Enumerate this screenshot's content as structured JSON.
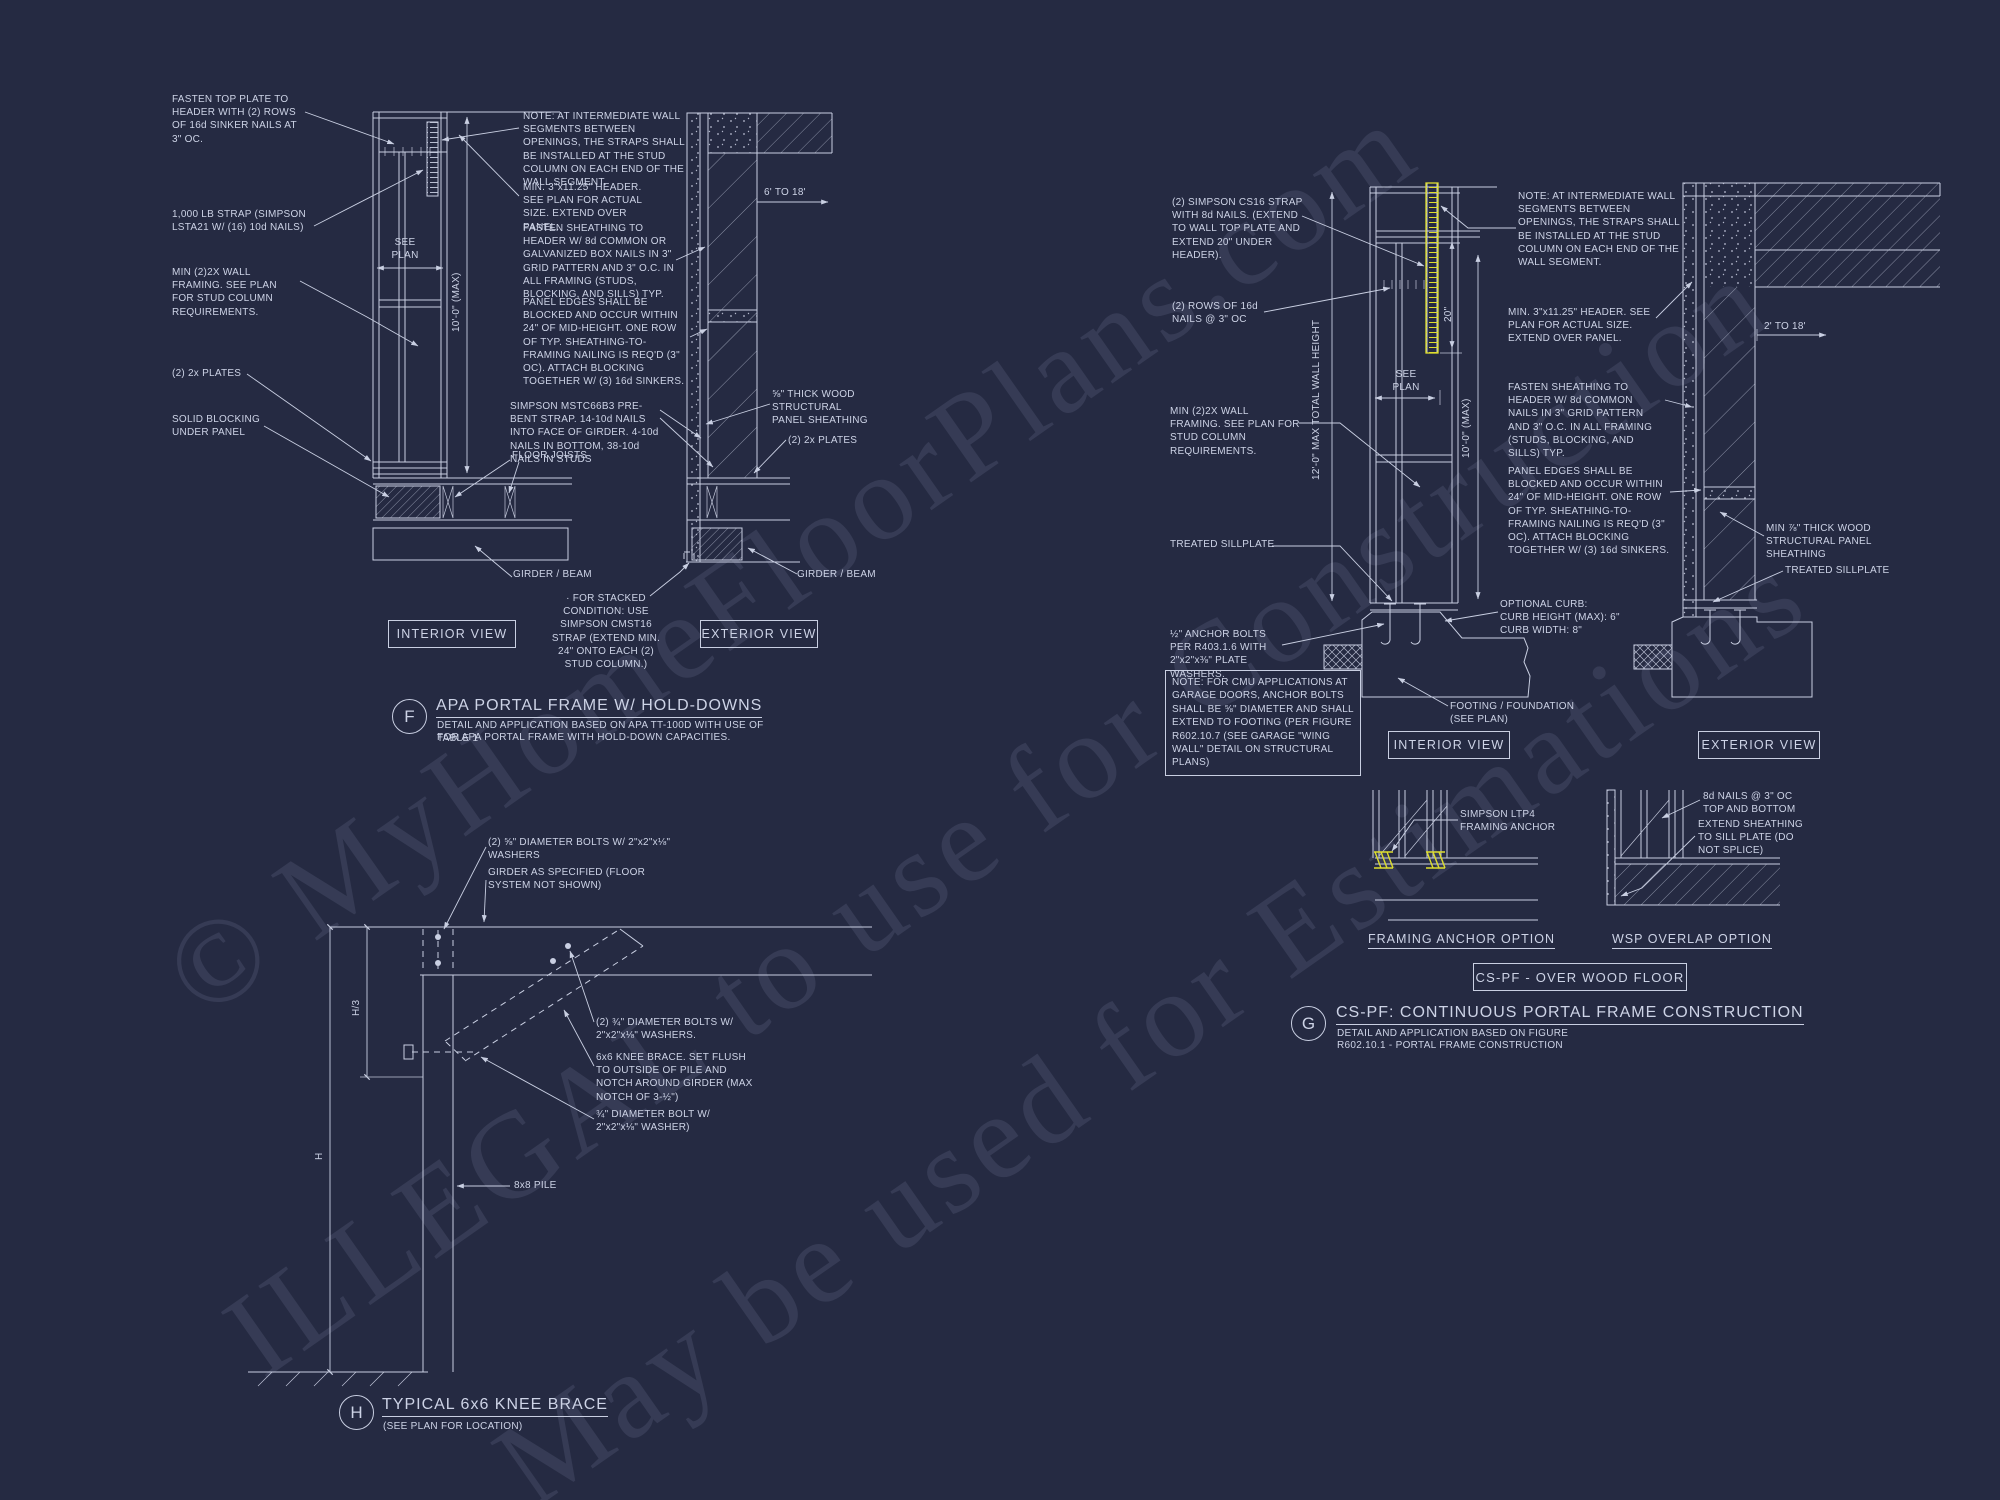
{
  "colors": {
    "background": "#252a42",
    "line": "#c9cfe2",
    "text": "#cdd3e6",
    "highlight": "#dede2e"
  },
  "watermark": {
    "line1": "© MyHomeFloorPlans.com",
    "line2": "ILLEGAL to use for Construction",
    "line3": "May be used for Estimations"
  },
  "f": {
    "tag": "F",
    "title": "APA PORTAL FRAME W/ HOLD-DOWNS",
    "subtitle1": "DETAIL AND APPLICATION BASED ON APA TT-100D WITH USE OF TABLE 1",
    "subtitle2": "FOR APA PORTAL FRAME WITH HOLD-DOWN CAPACITIES.",
    "interior_view": "INTERIOR VIEW",
    "exterior_view": "EXTERIOR VIEW",
    "labels": {
      "fasten_top_plate": "FASTEN TOP PLATE TO HEADER WITH (2) ROWS OF 16d SINKER NAILS AT 3\" OC.",
      "strap_1000lb": "1,000 LB STRAP (SIMPSON LSTA21 W/ (16) 10d NAILS)",
      "min_wall_framing": "MIN (2)2X WALL FRAMING. SEE PLAN FOR STUD COLUMN REQUIREMENTS.",
      "plates_left": "(2) 2x PLATES",
      "solid_blocking": "SOLID BLOCKING UNDER PANEL",
      "see_plan": "SEE\nPLAN",
      "height_max": "10'-0\" (MAX)",
      "note_intermediate": "NOTE: AT INTERMEDIATE WALL SEGMENTS BETWEEN OPENINGS, THE STRAPS SHALL BE INSTALLED AT THE STUD COLUMN ON EACH END OF THE WALL SEGMENT.",
      "min_header": "MIN. 3\"x11.25\" HEADER. SEE PLAN FOR ACTUAL SIZE. EXTEND OVER PANEL.",
      "fasten_sheathing": "FASTEN SHEATHING TO HEADER W/ 8d COMMON OR GALVANIZED BOX NAILS IN 3\" GRID PATTERN AND 3\" O.C. IN ALL FRAMING (STUDS, BLOCKING, AND SILLS) TYP.",
      "panel_edges": "PANEL EDGES SHALL BE BLOCKED AND OCCUR WITHIN 24\" OF MID-HEIGHT.  ONE ROW OF TYP. SHEATHING-TO-FRAMING NAILING IS REQ'D (3\" OC). ATTACH BLOCKING TOGETHER W/ (3) 16d SINKERS.",
      "simpson_strap": "SIMPSON MSTC66B3 PRE-BENT STRAP. 14-10d NAILS INTO FACE OF GIRDER. 4-10d NAILS IN BOTTOM, 38-10d NAILS IN STUDS",
      "floor_joists": "FLOOR JOISTS",
      "opening_range": "6' TO 18'",
      "sheathing": "⅝\" THICK WOOD STRUCTURAL PANEL SHEATHING",
      "plates_right": "(2) 2x PLATES",
      "girder_left": "GIRDER / BEAM",
      "girder_right": "GIRDER / BEAM",
      "stacked": "· FOR STACKED CONDITION: USE SIMPSON CMST16 STRAP (EXTEND MIN. 24\" ONTO EACH (2) STUD COLUMN.)"
    }
  },
  "g": {
    "tag": "G",
    "title": "CS-PF: CONTINUOUS PORTAL FRAME CONSTRUCTION",
    "subtitle1": "DETAIL AND APPLICATION BASED ON  FIGURE",
    "subtitle2": "R602.10.1 - PORTAL FRAME CONSTRUCTION",
    "over_wood_floor": "CS-PF - OVER WOOD FLOOR",
    "framing_option": "FRAMING ANCHOR OPTION",
    "wsp_option": "WSP OVERLAP OPTION",
    "interior_view": "INTERIOR VIEW",
    "exterior_view": "EXTERIOR VIEW",
    "labels": {
      "cs16_strap": "(2) SIMPSON CS16 STRAP WITH 8d NAILS. (EXTEND TO WALL TOP PLATE AND EXTEND 20\" UNDER HEADER).",
      "rows_16d": "(2) ROWS OF 16d NAILS @ 3\" OC",
      "wall_height": "12'-0\" MAX TOTAL WALL HEIGHT",
      "see_plan": "SEE\nPLAN",
      "dim_20": "20\"",
      "height_max": "10'-0\" (MAX)",
      "min_wall_framing": "MIN (2)2X WALL FRAMING. SEE PLAN FOR STUD COLUMN REQUIREMENTS.",
      "sillplate_left": "TREATED SILLPLATE",
      "anchor_bolts": "½\" ANCHOR BOLTS PER R403.1.6 WITH 2\"x2\"x⅜\" PLATE WASHERS.",
      "cmu_note": "NOTE: FOR CMU APPLICATIONS AT GARAGE DOORS, ANCHOR BOLTS SHALL BE ⅝\" DIAMETER AND SHALL EXTEND TO FOOTING (PER  FIGURE R602.10.7 (SEE GARAGE \"WING WALL\" DETAIL ON STRUCTURAL PLANS)",
      "note_intermediate": "NOTE: AT INTERMEDIATE WALL SEGMENTS BETWEEN OPENINGS, THE STRAPS SHALL BE INSTALLED AT THE STUD COLUMN ON EACH END OF THE WALL SEGMENT.",
      "min_header": "MIN. 3\"x11.25\" HEADER. SEE PLAN FOR ACTUAL SIZE. EXTEND OVER PANEL.",
      "fasten_sheathing": "FASTEN SHEATHING TO HEADER W/ 8d COMMON NAILS IN 3\" GRID PATTERN AND 3\" O.C. IN ALL FRAMING (STUDS, BLOCKING, AND SILLS) TYP.",
      "panel_edges": "PANEL EDGES SHALL BE BLOCKED AND OCCUR WITHIN 24\" OF MID-HEIGHT.  ONE ROW OF TYP. SHEATHING-TO-FRAMING NAILING IS REQ'D (3\" OC). ATTACH BLOCKING TOGETHER W/ (3) 16d SINKERS.",
      "optional_curb": "OPTIONAL CURB:\nCURB HEIGHT (MAX): 6\"\nCURB WIDTH: 8\"",
      "opening_range": "2' TO 18'",
      "min_sheathing": "MIN ⅞\" THICK WOOD STRUCTURAL PANEL SHEATHING",
      "sillplate_right": "TREATED SILLPLATE",
      "footing": "FOOTING / FOUNDATION (SEE PLAN)",
      "ltp4": "SIMPSON LTP4 FRAMING ANCHOR",
      "nails_8d": "8d NAILS @ 3\" OC TOP AND BOTTOM",
      "extend_sheathing": "EXTEND SHEATHING TO SILL PLATE (DO NOT SPLICE)"
    }
  },
  "h": {
    "tag": "H",
    "title": "TYPICAL 6x6 KNEE BRACE",
    "subtitle": "(SEE PLAN FOR LOCATION)",
    "labels": {
      "bolts_58": "(2) ⅝\" DIAMETER BOLTS W/ 2\"x2\"x⅛\" WASHERS",
      "girder_spec": "GIRDER AS SPECIFIED (FLOOR SYSTEM NOT SHOWN)",
      "bolts_34": "(2) ¾\" DIAMETER BOLTS W/ 2\"x2\"x⅛\" WASHERS.",
      "knee_brace": "6x6 KNEE BRACE. SET FLUSH TO OUTSIDE OF PILE AND NOTCH AROUND GIRDER (MAX NOTCH OF 3-½\")",
      "bolt_34": "¾\" DIAMETER BOLT W/ 2\"x2\"x⅛\" WASHER)",
      "pile": "8x8 PILE",
      "dim_h3": "H/3",
      "dim_h": "H"
    }
  }
}
